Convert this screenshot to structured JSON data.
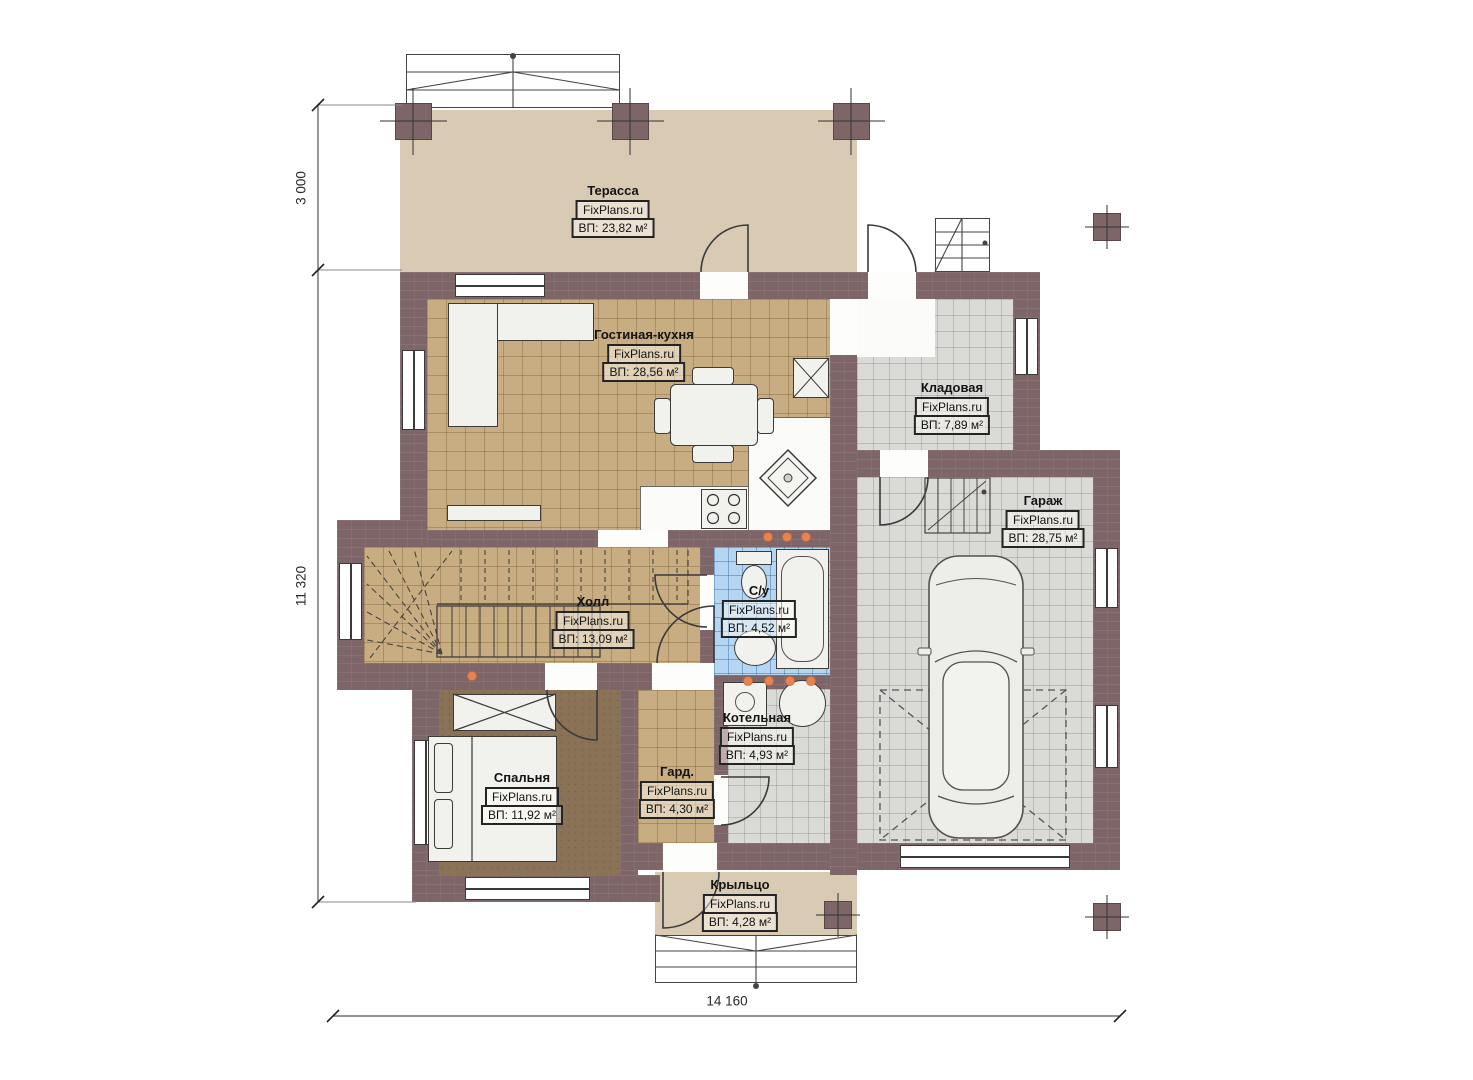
{
  "brand": "FixPlans.ru",
  "rooms": {
    "terrace": {
      "name": "Терасса",
      "area": "ВП: 23,82 м²"
    },
    "living_kitchen": {
      "name": "Гостиная-кухня",
      "area": "ВП: 28,56 м²"
    },
    "storage": {
      "name": "Кладовая",
      "area": "ВП: 7,89 м²"
    },
    "garage": {
      "name": "Гараж",
      "area": "ВП: 28,75 м²"
    },
    "hall": {
      "name": "Холл",
      "area": "ВП: 13,09 м²"
    },
    "bathroom": {
      "name": "С/у",
      "area": "ВП: 4,52 м²"
    },
    "boiler": {
      "name": "Котельная",
      "area": "ВП: 4,93 м²"
    },
    "bedroom": {
      "name": "Спальня",
      "area": "ВП: 11,92 м²"
    },
    "wardrobe": {
      "name": "Гард.",
      "area": "ВП: 4,30 м²"
    },
    "porch": {
      "name": "Крыльцо",
      "area": "ВП: 4,28 м²"
    }
  },
  "dimensions": {
    "terrace_depth": "3 000",
    "house_depth": "11 320",
    "house_width": "14 160"
  },
  "colors": {
    "wall": "#7e6567",
    "floor_tan": "#c8ad83",
    "floor_gray": "#dadad7",
    "floor_blue": "#b4d6f2",
    "floor_beige": "#d9cab4",
    "floor_bedroom": "#8a7256",
    "marker_orange": "#e8834f"
  }
}
